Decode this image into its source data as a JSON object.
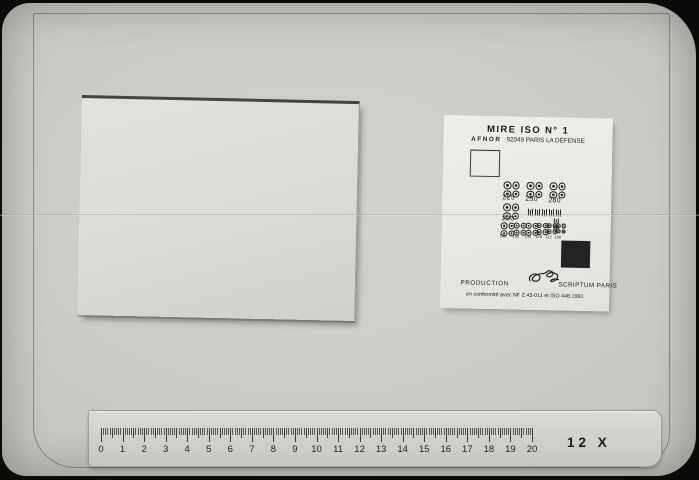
{
  "photo": {
    "magnification_label": "12 X"
  },
  "test_card": {
    "title": "MIRE ISO N° 1",
    "org": "AFNOR",
    "address": "92049 PARIS LA DÉFENSE",
    "cluster_labels_row1": [
      "225",
      "250",
      "280"
    ],
    "cluster_label_row2": "200",
    "cluster_labels_row3": [
      "180",
      "160",
      "140",
      "125",
      "112",
      "100"
    ],
    "production_label": "PRODUCTION",
    "producer_label": "SCRIPTUM PARIS",
    "conformity_note": "en conformité avec NF Z 43-011 et ISO 446:1991"
  },
  "ruler": {
    "numbers": [
      "0",
      "1",
      "2",
      "3",
      "4",
      "5",
      "6",
      "7",
      "8",
      "9",
      "10",
      "11",
      "12",
      "13",
      "14",
      "15",
      "16",
      "17",
      "18",
      "19",
      "20"
    ]
  },
  "colors": {
    "board": "#c9c9c5",
    "card": "#e9e9e5",
    "ink": "#1e1e1e",
    "black_patch": "#232323"
  }
}
